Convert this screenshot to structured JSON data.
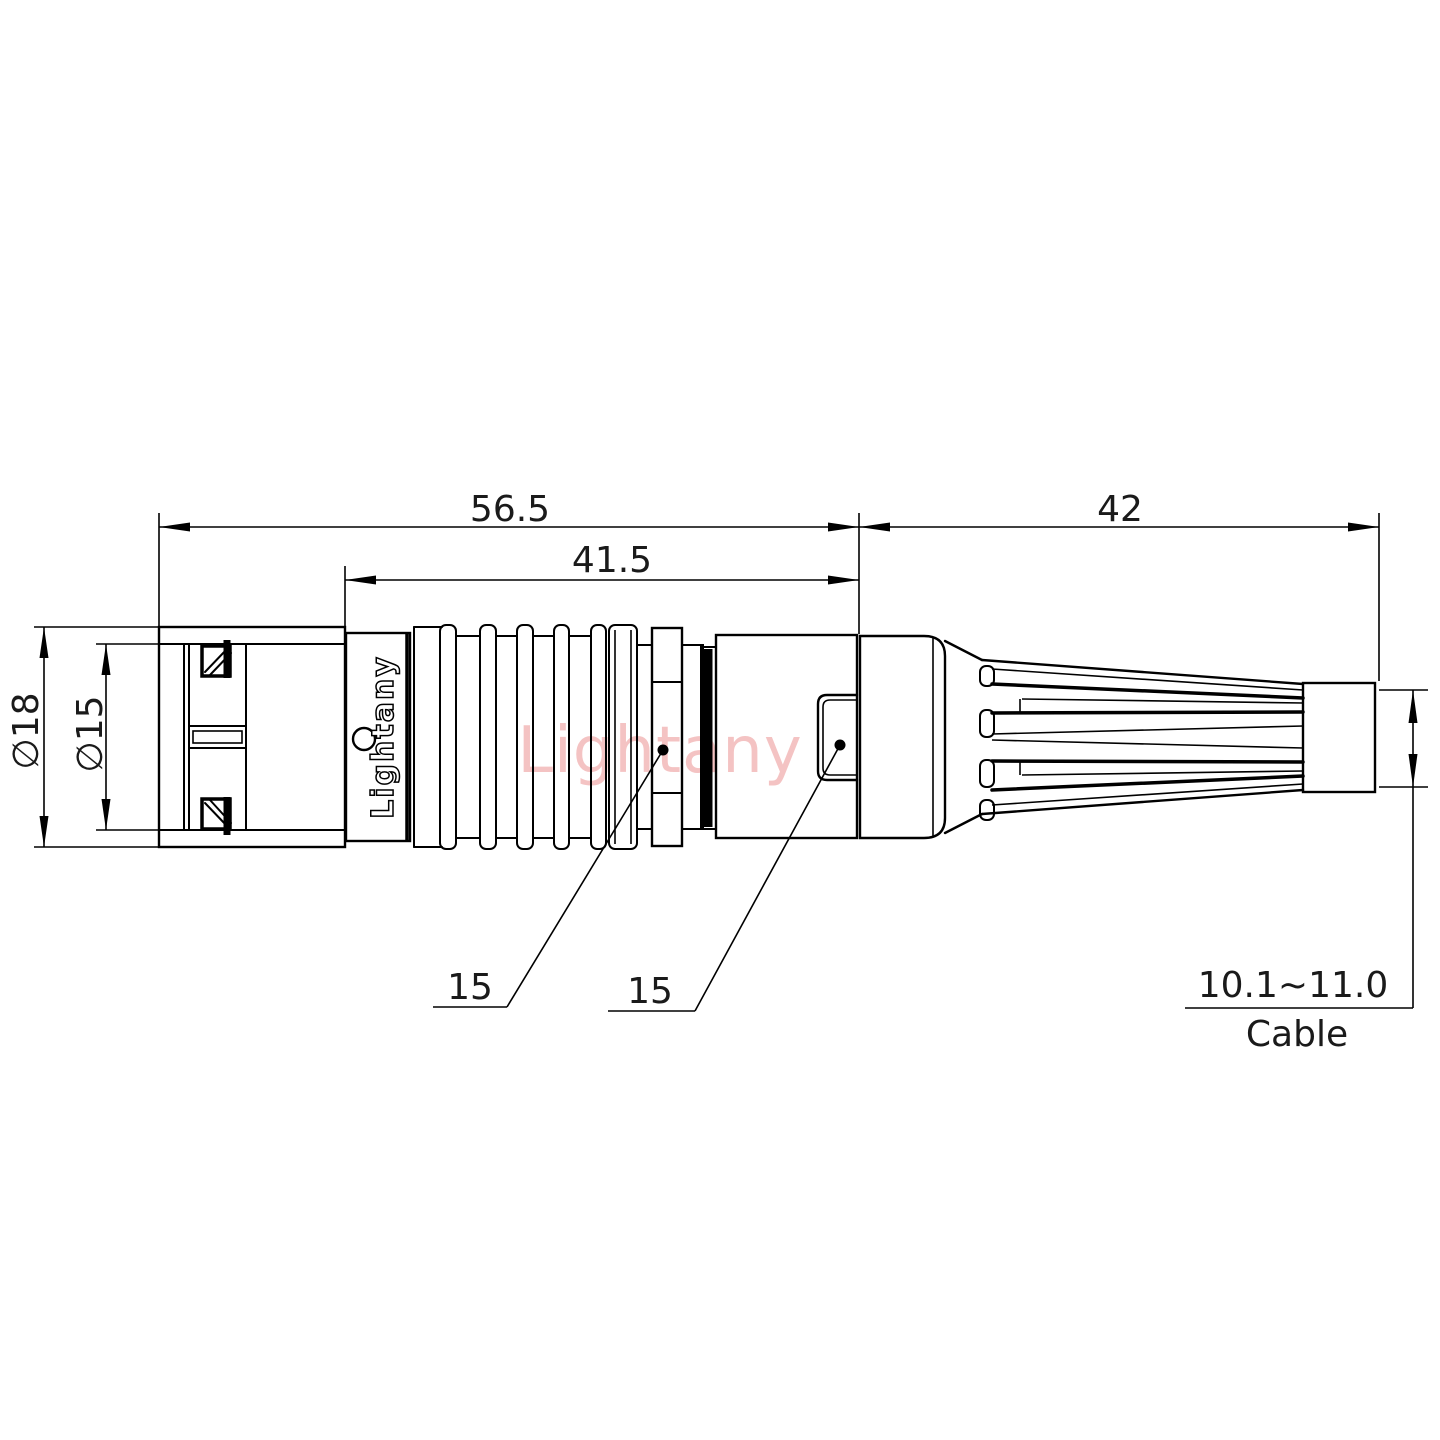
{
  "dimensions": {
    "overall_length": "56.5",
    "coupling_length": "41.5",
    "boot_length": "42",
    "outer_diameter": "∅18",
    "inner_diameter": "∅15",
    "leader_left_value": "15",
    "leader_right_value": "15",
    "cable_range": "10.1~11.0",
    "cable_label": "Cable"
  },
  "branding": {
    "body_text": "Lightany",
    "watermark_text": "Lightany"
  },
  "colors": {
    "line": "#000000",
    "watermark": "#f2b5b5",
    "background": "#ffffff"
  }
}
